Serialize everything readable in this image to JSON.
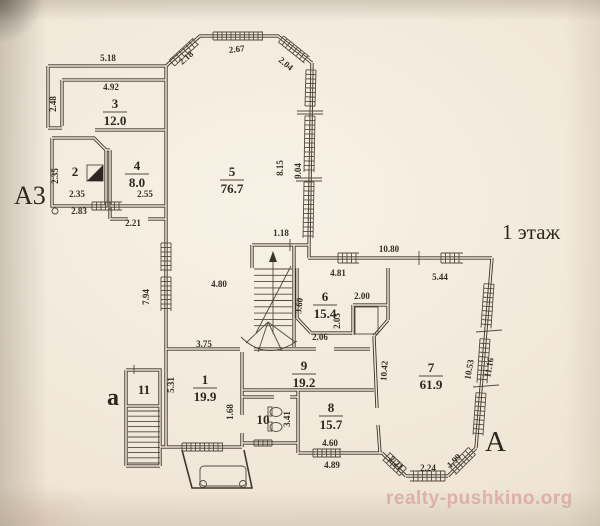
{
  "floor_label": "1 этаж",
  "watermark": "realty-pushkino.org",
  "axis_labels": [
    {
      "id": "a3",
      "text": "А3"
    },
    {
      "id": "a-lower",
      "text": "а"
    },
    {
      "id": "a-right",
      "text": "А"
    }
  ],
  "rooms": [
    {
      "number": "3",
      "area": "12.0",
      "x": 115,
      "y": 108
    },
    {
      "number": "2",
      "area": "",
      "x": 75,
      "y": 176
    },
    {
      "number": "4",
      "area": "8.0",
      "x": 137,
      "y": 170
    },
    {
      "number": "5",
      "area": "76.7",
      "x": 232,
      "y": 176
    },
    {
      "number": "6",
      "area": "15.4",
      "x": 325,
      "y": 301
    },
    {
      "number": "7",
      "area": "61.9",
      "x": 431,
      "y": 372
    },
    {
      "number": "8",
      "area": "15.7",
      "x": 331,
      "y": 412
    },
    {
      "number": "9",
      "area": "19.2",
      "x": 304,
      "y": 370
    },
    {
      "number": "10",
      "area": "",
      "x": 263,
      "y": 424
    },
    {
      "number": "1",
      "area": "19.9",
      "x": 205,
      "y": 384
    },
    {
      "number": "11",
      "area": "",
      "x": 144,
      "y": 394
    }
  ],
  "dimensions": [
    {
      "text": "5.18",
      "x": 108,
      "y": 61
    },
    {
      "text": "4.92",
      "x": 111,
      "y": 90
    },
    {
      "text": "2.48",
      "x": 56,
      "y": 104,
      "rot": -90
    },
    {
      "text": "2.18",
      "x": 188,
      "y": 60,
      "rot": -41
    },
    {
      "text": "2.67",
      "x": 237,
      "y": 52,
      "rot": -6
    },
    {
      "text": "2.04",
      "x": 284,
      "y": 66,
      "rot": 40
    },
    {
      "text": "8.15",
      "x": 283,
      "y": 168,
      "rot": -90
    },
    {
      "text": "9.04",
      "x": 301,
      "y": 171,
      "rot": -90
    },
    {
      "text": "2.35",
      "x": 58,
      "y": 176,
      "rot": -90
    },
    {
      "text": "2.35",
      "x": 77,
      "y": 197
    },
    {
      "text": "2.83",
      "x": 79,
      "y": 214
    },
    {
      "text": "2.55",
      "x": 145,
      "y": 197
    },
    {
      "text": "2.21",
      "x": 133,
      "y": 226
    },
    {
      "text": "1.18",
      "x": 281,
      "y": 236
    },
    {
      "text": "10.80",
      "x": 389,
      "y": 252
    },
    {
      "text": "4.81",
      "x": 338,
      "y": 276
    },
    {
      "text": "5.44",
      "x": 440,
      "y": 280
    },
    {
      "text": "4.80",
      "x": 219,
      "y": 287
    },
    {
      "text": "7.94",
      "x": 149,
      "y": 297,
      "rot": -90
    },
    {
      "text": "3.60",
      "x": 302,
      "y": 306,
      "rot": -84
    },
    {
      "text": "2.00",
      "x": 362,
      "y": 299
    },
    {
      "text": "2.03",
      "x": 340,
      "y": 321,
      "rot": -90
    },
    {
      "text": "2.06",
      "x": 320,
      "y": 340
    },
    {
      "text": "3.75",
      "x": 204,
      "y": 347
    },
    {
      "text": "5.31",
      "x": 174,
      "y": 385,
      "rot": -90
    },
    {
      "text": "1.68",
      "x": 233,
      "y": 412,
      "rot": -90
    },
    {
      "text": "3.41",
      "x": 290,
      "y": 419,
      "rot": -90
    },
    {
      "text": "4.60",
      "x": 330,
      "y": 446
    },
    {
      "text": "4.89",
      "x": 332,
      "y": 468
    },
    {
      "text": "10.42",
      "x": 387,
      "y": 371,
      "rot": -86
    },
    {
      "text": "10.53",
      "x": 472,
      "y": 370,
      "rot": -80
    },
    {
      "text": "11.16",
      "x": 492,
      "y": 368,
      "rot": -80
    },
    {
      "text": "2.21",
      "x": 394,
      "y": 465,
      "rot": 44
    },
    {
      "text": "2.24",
      "x": 428,
      "y": 471
    },
    {
      "text": "1.99",
      "x": 456,
      "y": 463,
      "rot": -44
    }
  ]
}
